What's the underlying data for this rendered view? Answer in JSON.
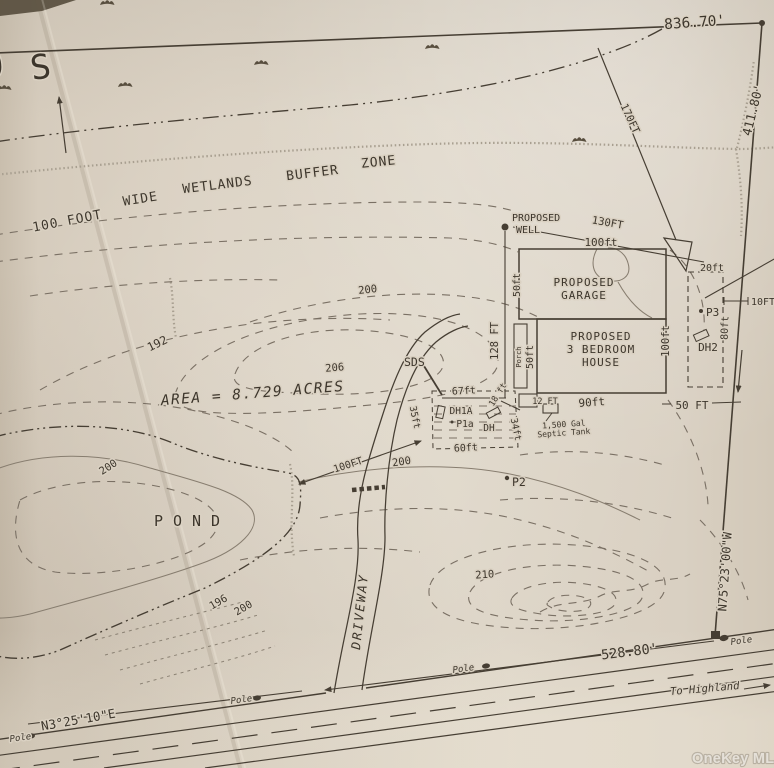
{
  "map": {
    "corner_o": "O",
    "corner_s": "S",
    "watermark": "OneKey MLS"
  },
  "boundary": {
    "top": "836.70'",
    "right": "411.80'",
    "bearing_right": "N75°23'00\"W",
    "frontage": "528.80'",
    "bearing_road": "N3°25'10\"E",
    "seg170": "170FT",
    "well_dist": "130FT"
  },
  "buffer": {
    "w1": "100 FOOT",
    "w2": "WIDE",
    "w3": "WETLANDS",
    "w4": "BUFFER",
    "w5": "ZONE"
  },
  "labels": {
    "area": "AREA = 8.729 ACRES",
    "pond": "POND",
    "pond_dist": "100FT",
    "driveway": "DRIVEWAY",
    "to_highland": "To Highland",
    "pole": "Pole"
  },
  "well": {
    "l1": "PROPOSED",
    "l2": "WELL"
  },
  "garage": {
    "l1": "PROPOSED",
    "l2": "GARAGE",
    "top": "100ft",
    "side": "50ft"
  },
  "house": {
    "l1": "PROPOSED",
    "l2": "3 BEDROOM",
    "l3": "HOUSE",
    "side": "50ft",
    "porch": "Porch",
    "bottom": "90ft",
    "right": "100ft",
    "overall": "128 FT"
  },
  "septic": {
    "sds": "SDS",
    "d67": "67ft",
    "d35": "35ft",
    "d34": "34ft",
    "d60": "60ft",
    "d12": "12 FT",
    "d18": "18 ft",
    "tank1": "1,500 Gal",
    "tank2": "Septic Tank",
    "dh1a": "DH1A",
    "p1a": "P1a",
    "dh": "DH"
  },
  "expansion": {
    "d20": "20ft",
    "p3": "P3",
    "dh2": "DH2",
    "d80": "80ft",
    "d10": "10FT",
    "d50": "50 FT"
  },
  "points": {
    "p2": "P2"
  },
  "contours": {
    "c192": "192",
    "c200a": "200",
    "c206": "206",
    "c200b": "200",
    "c200c": "200",
    "c196": "196",
    "c200d": "200",
    "c210": "210"
  }
}
